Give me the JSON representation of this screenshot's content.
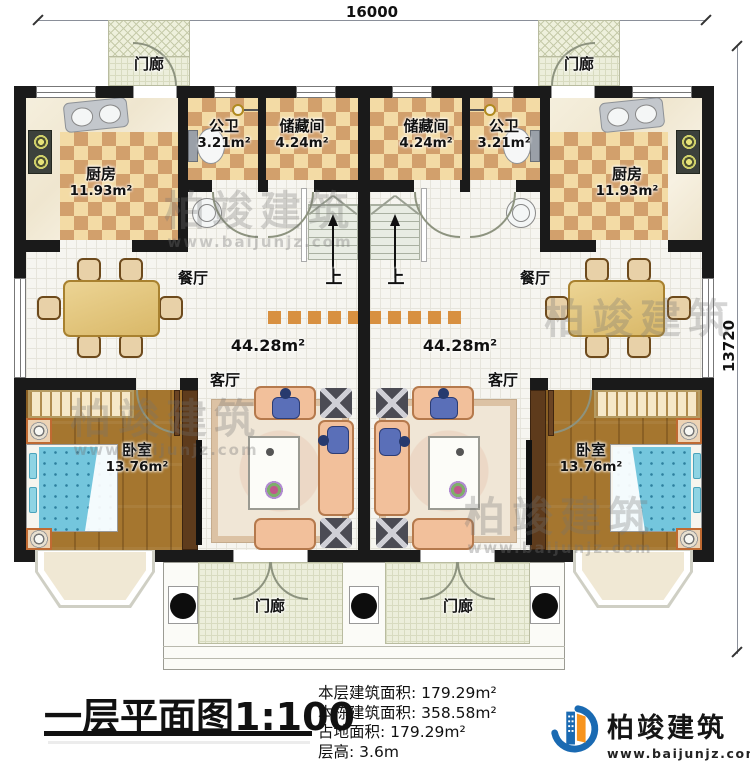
{
  "plan": {
    "dimension_top": "16000",
    "dimension_right": "13720",
    "rooms": {
      "porch": "门廊",
      "kitchen": "厨房",
      "kitchen_area": "11.93m²",
      "bath": "公卫",
      "bath_area": "3.21m²",
      "storage": "储藏间",
      "storage_area": "4.24m²",
      "dining": "餐厅",
      "living": "客厅",
      "living_area": "44.28m²",
      "bedroom": "卧室",
      "bedroom_area": "13.76m²",
      "stairs_up": "上"
    }
  },
  "footer": {
    "title": "一层平面图",
    "scale": "1:100",
    "stats": [
      {
        "label": "本层建筑面积:",
        "value": "179.29m²"
      },
      {
        "label": "本栋建筑面积:",
        "value": "358.58m²"
      },
      {
        "label": "占地面积:",
        "value": "179.29m²"
      },
      {
        "label": "层高:",
        "value": "3.6m"
      }
    ],
    "brand": {
      "name": "柏竣建筑",
      "site": "www.baijunjz.com"
    }
  },
  "watermark": {
    "name": "柏竣建筑",
    "site": "www.baijunjz.com"
  },
  "colors": {
    "wall": "#1a1a1a",
    "checker_dark": "#d2a06c",
    "checker_light": "#f3dba5",
    "wood_floor": "#a5762f",
    "bed_blue": "#74c6dd",
    "brand_blue": "#1a6ab2",
    "brand_orange": "#f7941e"
  }
}
